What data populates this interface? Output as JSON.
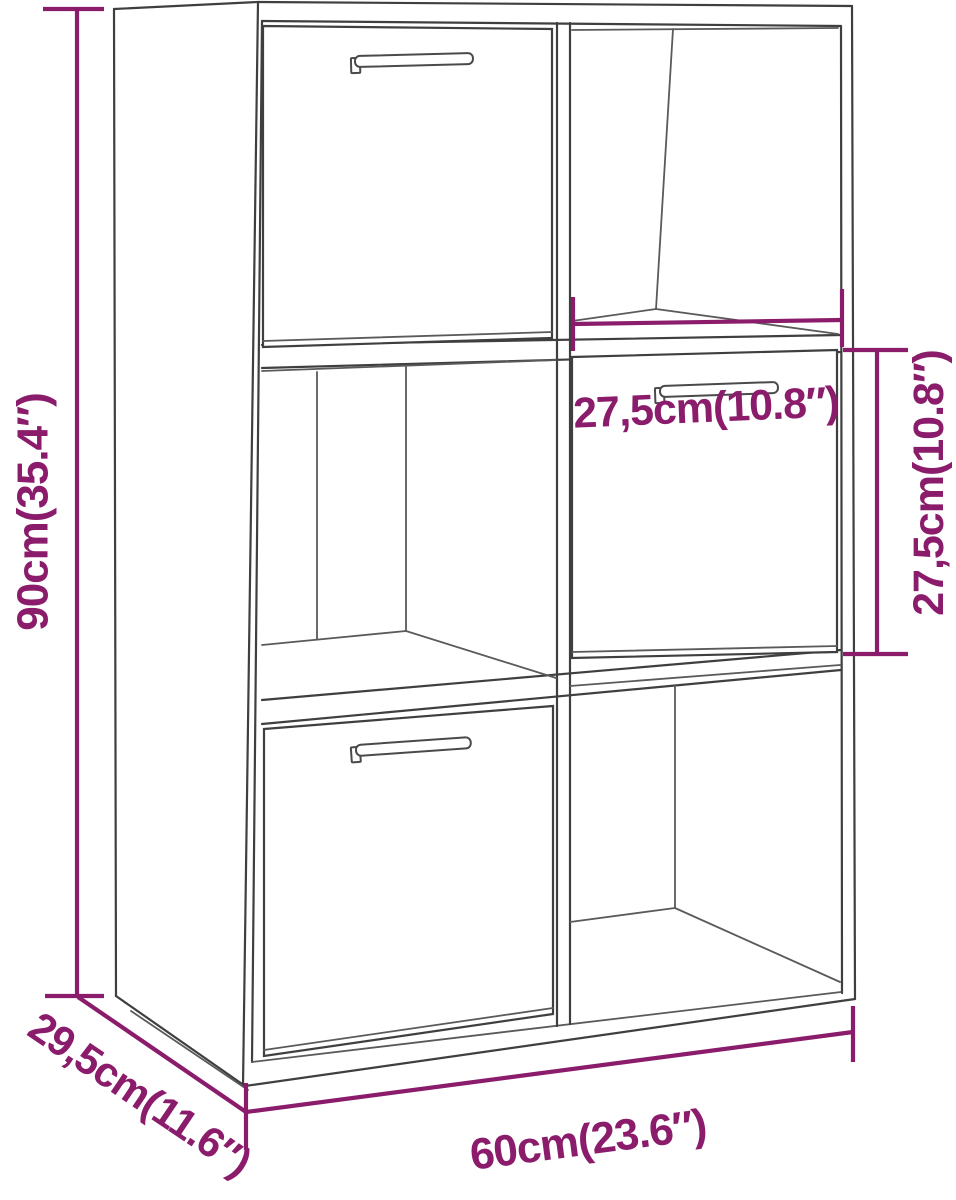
{
  "colors": {
    "dimension_accent": "#8b1c6b",
    "cabinet_outline": "#3f3f3f",
    "background": "#ffffff"
  },
  "dimensions": {
    "height": {
      "label": "90cm(35.4″)",
      "cm": "90",
      "inches": "35.4"
    },
    "depth": {
      "label": "29,5cm(11.6″)",
      "cm": "29,5",
      "inches": "11.6"
    },
    "width": {
      "label": "60cm(23.6″)",
      "cm": "60",
      "inches": "23.6"
    },
    "compartment_width": {
      "label": "27,5cm(10.8″)",
      "cm": "27,5",
      "inches": "10.8"
    },
    "compartment_height": {
      "label": "27,5cm(10.8″)",
      "cm": "27,5",
      "inches": "10.8"
    }
  }
}
